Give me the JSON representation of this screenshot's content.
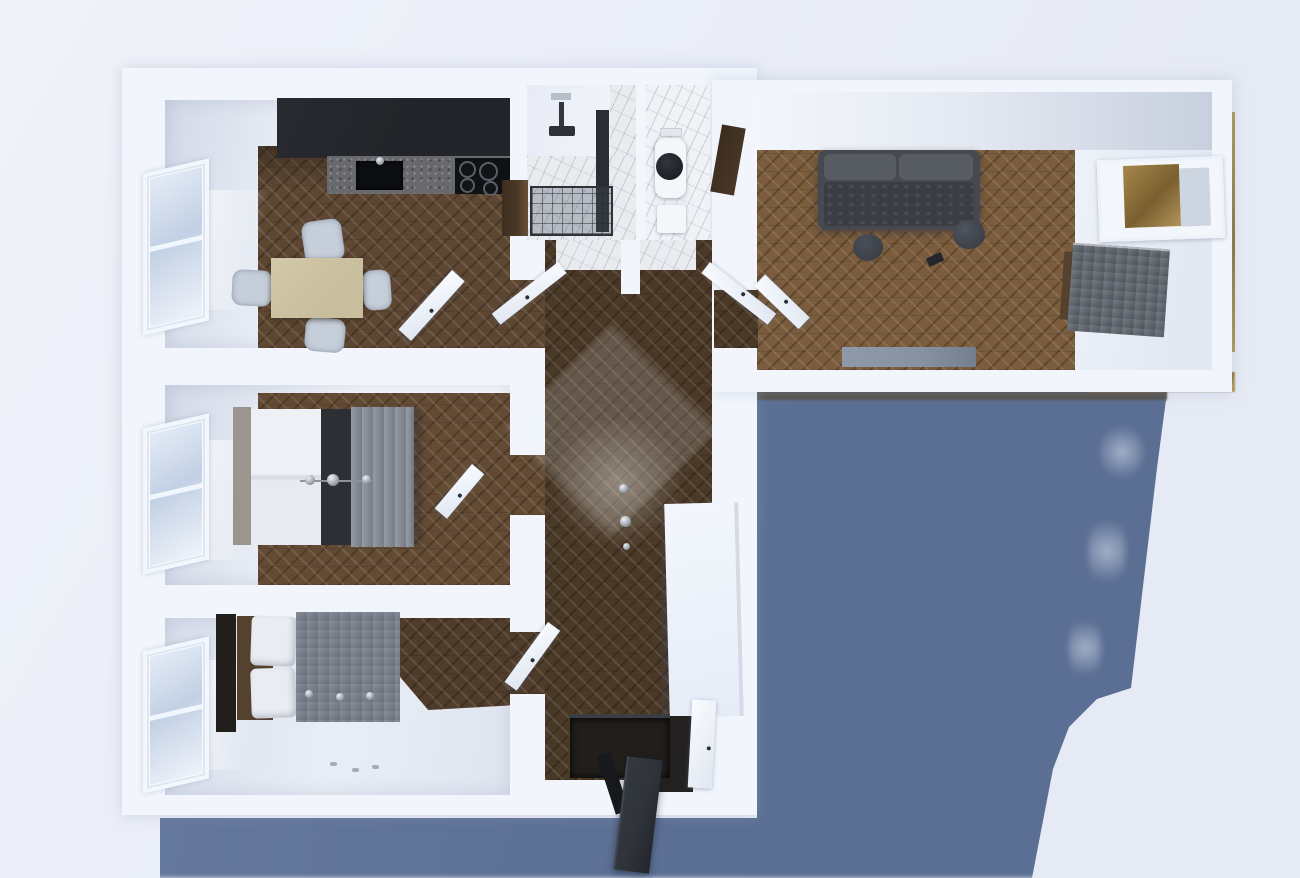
{
  "scene": {
    "type": "3D architectural floor-plan render",
    "view": "top-down dollhouse view of a two-bedroom apartment",
    "lighting": "daylight from upper left casting a blue-grey shadow toward the lower right",
    "floors": "dark herringbone parquet with white walls and marble wet rooms"
  },
  "colors": {
    "bg_1": "#eff2f9",
    "bg_2": "#e6eaf4",
    "shadow_1": "#6b7ea1",
    "shadow_2": "#5b6f94",
    "wall": "#f2f6fc",
    "wall_shade": "#dde4ef",
    "face_1": "#d2d9e7",
    "face_2": "#f4f7fc",
    "wood_kitchen": "#5e4732",
    "wood_hall": "#4b3927",
    "wood_bedroom": "#634b33",
    "wood_bedroom_dark": "#4f3c2a",
    "wood_living": "#7b5c3c",
    "counter_dark": "#222429",
    "counter_stone": "#67696e",
    "appliance_black": "#0c0d10",
    "steel": "#5a5f67",
    "table_beige": "#c8bd9c",
    "chair_gray": "#c6ceda",
    "sofa_body": "#46494f",
    "sofa_seat": "#3a3d43",
    "sofa_cushion": "#575b62",
    "side_table": "#3c4048",
    "sideboard_gray": "#8791a0",
    "pillow_white": "#e9ecf1",
    "bed_runner": "#2c2f34",
    "bed_blanket": "#858d99",
    "bed_duvet": "#7a828e",
    "headboard_light": "#9b958d",
    "headboard_dark": "#221e1b",
    "bed_brown": "#54422f",
    "marble": "#e9ebef",
    "marble_vein": "#a9afbd",
    "toilet_lid": "#1e2126",
    "porcelain": "#f4f6f9",
    "door_walnut": "#4a3827",
    "entry_door": "#2f333a",
    "entry_mat": "#211e1b",
    "brass_1": "#b59450",
    "brass_2": "#8c6f35",
    "glass_blue": "#c3d0e4",
    "lit_floor": "#edf1f8",
    "chrome": "#c4cad2",
    "glow": "#fdfbf2",
    "desk_gray": "#5f666f",
    "wardrobe_white": "#f3f7fd"
  },
  "rooms": {
    "kitchen": {
      "name": "Kitchen / dining room",
      "furniture": [
        "dark kitchen counter",
        "black sink",
        "cooktop",
        "beige dining table",
        "four grey chairs",
        "window",
        "open white door"
      ]
    },
    "bathroom": {
      "name": "Bathroom",
      "furniture": [
        "walk-in shower with dark glass frame",
        "ceiling shower head",
        "wood vanity",
        "marble floor"
      ]
    },
    "wc": {
      "name": "WC",
      "furniture": [
        "toilet with black lid",
        "small sink",
        "walnut door"
      ]
    },
    "living": {
      "name": "Living room",
      "furniture": [
        "grey sofa",
        "two round side tables",
        "grey sideboard",
        "desk with chair",
        "brass-framed mirror",
        "window",
        "balcony brass railing"
      ]
    },
    "bedroom_middle": {
      "name": "Bedroom",
      "furniture": [
        "double bed with grey blanket and dark runner",
        "chrome knobs",
        "window",
        "open door"
      ]
    },
    "bedroom_bottom": {
      "name": "Second bedroom",
      "furniture": [
        "double bed with grey duvet and white pillows",
        "dark headboard",
        "window",
        "open door"
      ]
    },
    "hallway": {
      "name": "Hallway",
      "furniture": [
        "white wardrobe",
        "glass pendant lamp",
        "skylight glow",
        "dark entry mat",
        "open entrance door"
      ]
    }
  }
}
